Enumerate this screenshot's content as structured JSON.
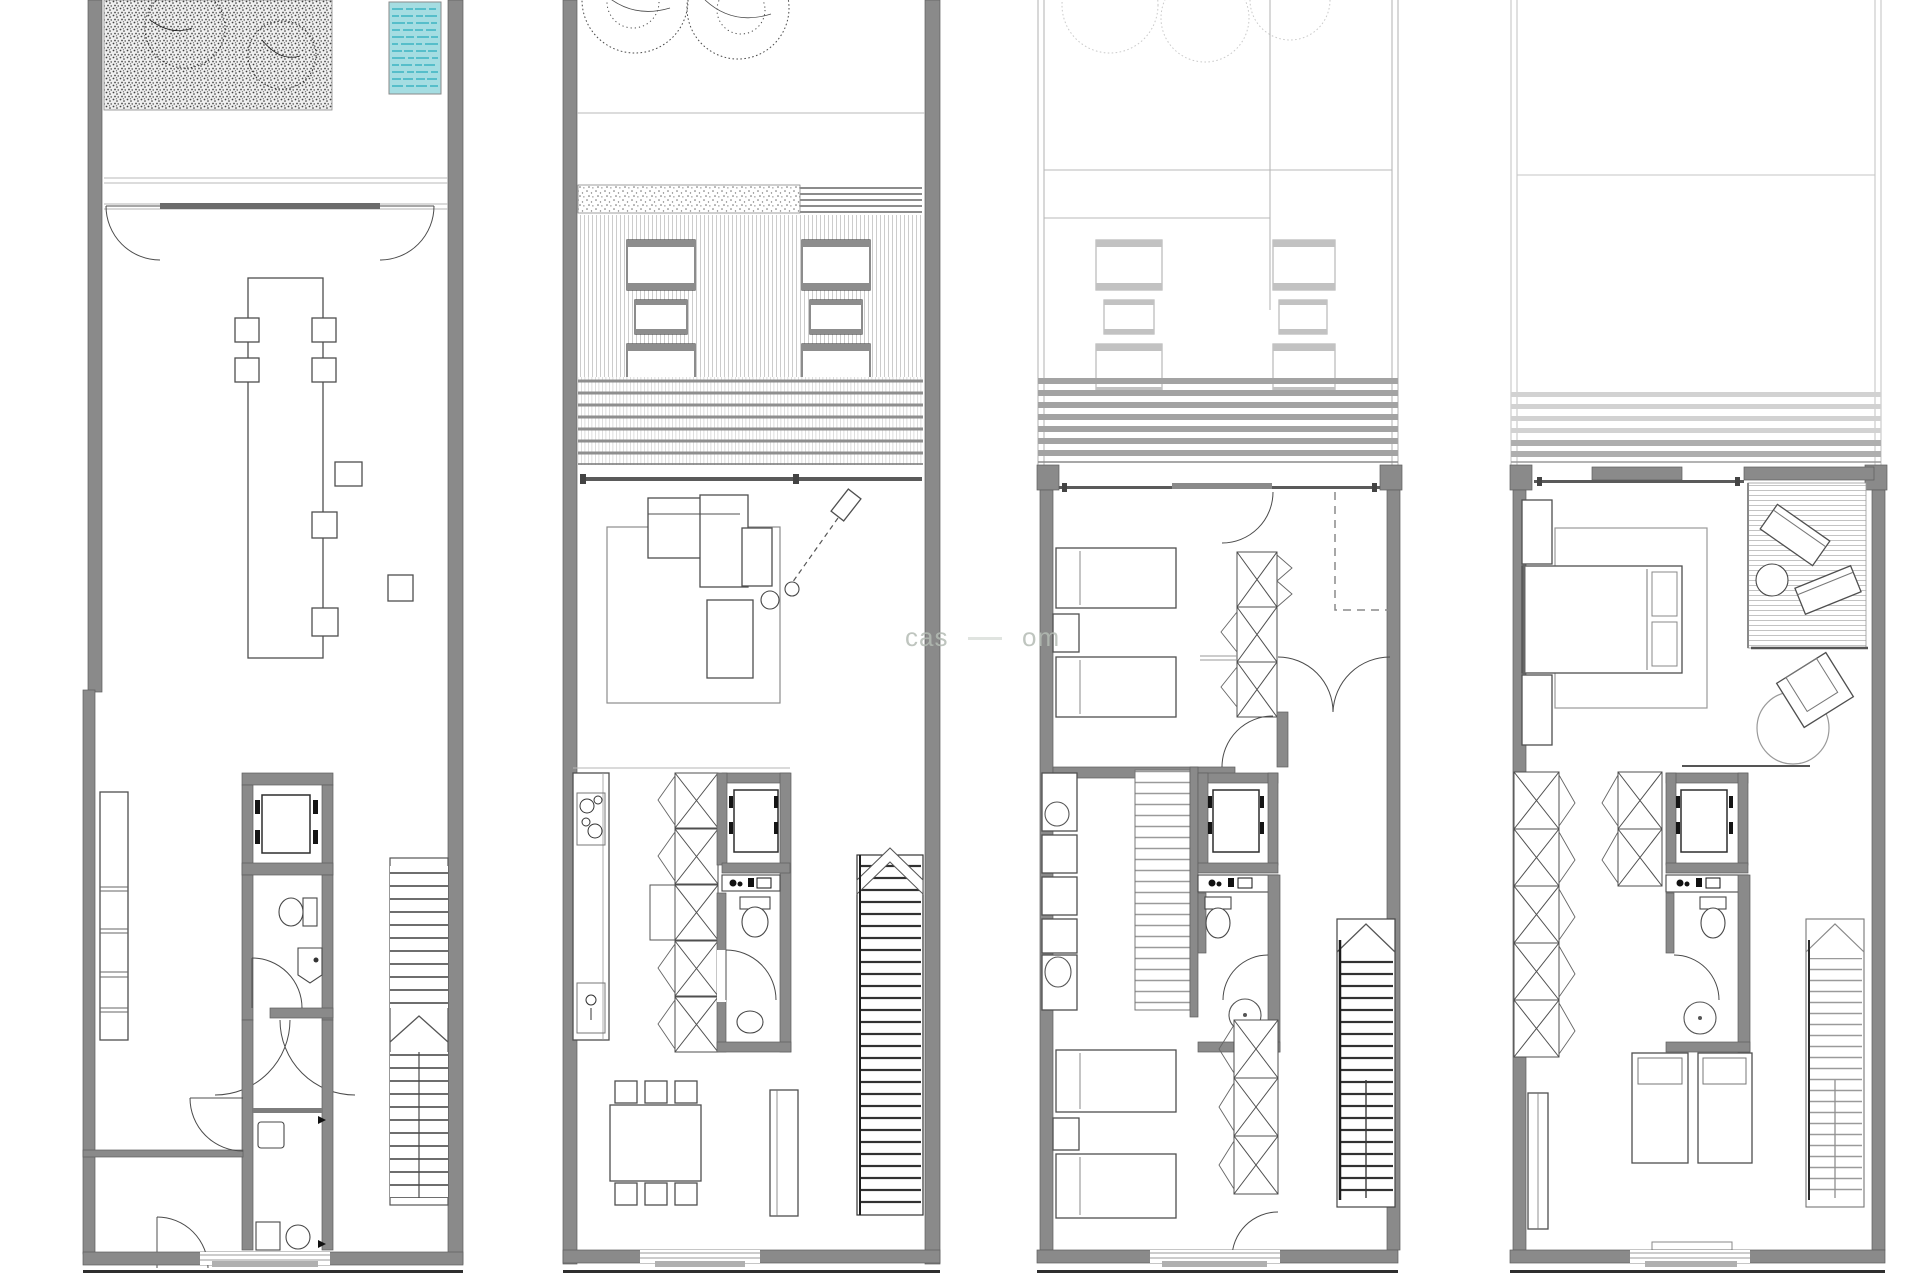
{
  "document": {
    "kind": "architectural-floor-plan-sheet",
    "plans_count": 4,
    "background": "#ffffff",
    "notes": "Four stacked-storey plans of a narrow townhouse drawn side by side; no title block or dimension text visible"
  },
  "watermark": {
    "fragment_left": "cas",
    "fragment_right": "om",
    "color": "#b4bcb4"
  },
  "palette": {
    "wall_gray": "#8a8a8a",
    "light_wall_gray": "#9c9c9c",
    "dark_line": "#4f4f4f",
    "light_line": "#bdbdbd",
    "pool_fill": "#a5dde2",
    "pool_wave": "#3db3c2",
    "deck_stripe": "#c6c6c6",
    "stair_rung_dark": "#303030",
    "stair_rung_light": "#9a9a9a"
  },
  "floors": [
    {
      "id": "plan-1",
      "position": "far-left",
      "features": [
        "planted garden with stippled ground and two trees",
        "teal lap pool",
        "double terrace edge line",
        "two swing entry doors",
        "long refectory table with four chairs and loose stools",
        "wall shelving band",
        "elevator shaft",
        "wc with toilet and basin",
        "fan double door",
        "laundry with two machines",
        "straight stair with mid-landing arrow"
      ]
    },
    {
      "id": "plan-2",
      "position": "center-left",
      "features": [
        "two canopy trees",
        "gravel strip",
        "timber deck with two groups of sun loungers",
        "louvered pergola band",
        "sliding glass wall",
        "living room with sofa, chaise, arm rest, floor lamp, rug, side tables",
        "linear kitchen with cooktop and sink",
        "wardrobe column with hinged doors",
        "elevator shaft",
        "bathroom with basin counter, toilet and bidet",
        "dining table with six chairs",
        "sideboard",
        "dark-runged straight stair with arrow"
      ]
    },
    {
      "id": "plan-3",
      "position": "center-right",
      "features": [
        "faint roof trees",
        "light patio outline with two lounge groups",
        "louver band",
        "sliding window wall",
        "bedroom with two single beds and nightstand",
        "triple wardrobe with X-fronts and hinged doors",
        "dashed void edge",
        "pair of swing doors",
        "hall washbasin cabinet",
        "internal stair flight",
        "elevator shaft",
        "bathroom with toilet and shower",
        "second bedroom with two single beds",
        "lower wardrobe column",
        "dark-runged stair with arrow"
      ]
    },
    {
      "id": "plan-4",
      "position": "far-right",
      "features": [
        "empty roof outline",
        "light louver band",
        "master bedroom with double bed, pillows, nightstands and rug",
        "private slatted terrace with two rotated loungers and round table",
        "rotated armchair with round rug",
        "five-box wardrobe column",
        "second wardrobe column",
        "elevator shaft",
        "bathroom with toilet and shower",
        "two single beds",
        "sideboard",
        "light-runged stair with arrow",
        "window bench at facade"
      ]
    }
  ]
}
